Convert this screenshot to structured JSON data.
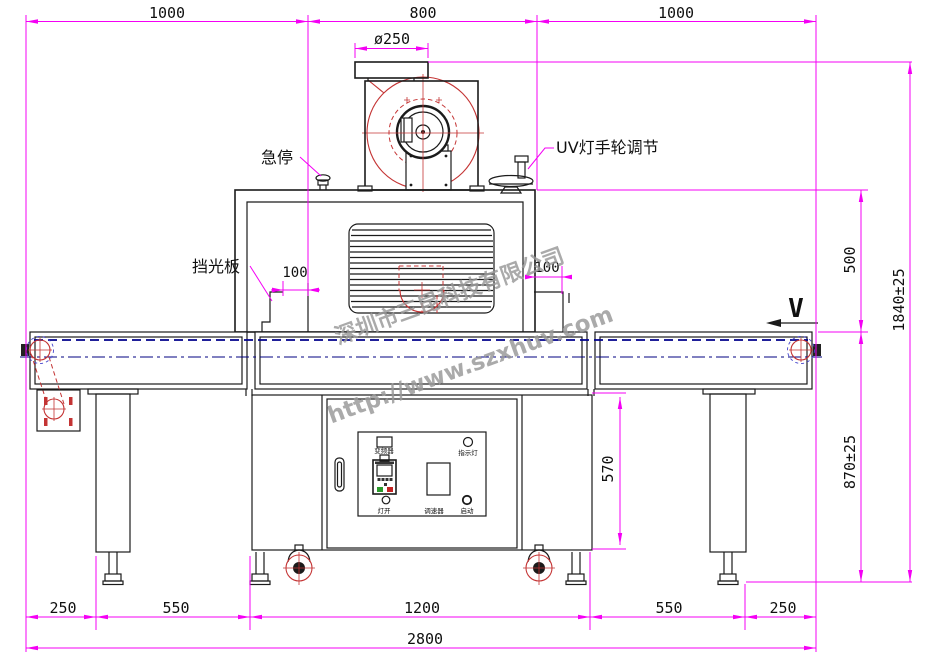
{
  "dimensions": {
    "top": [
      "1000",
      "800",
      "1000"
    ],
    "flange_diameter": "ø250",
    "gap_left": "100",
    "gap_right": "100",
    "lamp_to_belt": "500",
    "total_height": "1840±25",
    "belt_height": "870±25",
    "cabinet_height": "570",
    "bottom": [
      "250",
      "550",
      "1200",
      "550",
      "250"
    ],
    "total_width": "2800"
  },
  "labels": {
    "emergency_stop": "急停",
    "uv_handwheel": "UV灯手轮调节",
    "light_shield": "挡光板",
    "belt_direction": "V"
  },
  "control_panel": {
    "inverter": "变频器",
    "indicator_light": "指示灯",
    "lamp_on": "灯开",
    "speed_controller": "调速器",
    "start": "启动"
  },
  "watermark": {
    "company": "深圳市三昆科技有限公司",
    "url": "http://www.szxhuv.com"
  },
  "colors": {
    "dimension": "#f400f4",
    "outline": "#1b1b1b",
    "detail_red": "#c43434",
    "belt_blue": "#00008b",
    "watermark_gray": "#989898"
  }
}
